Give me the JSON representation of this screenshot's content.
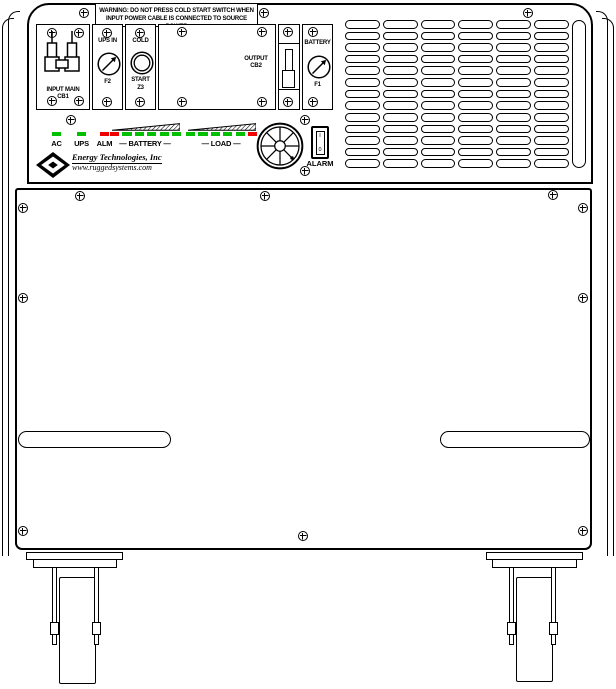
{
  "warning_label": {
    "line1": "WARNING: DO NOT PRESS COLD START SWITCH WHEN",
    "line2": "INPUT POWER CABLE IS CONNECTED TO SOURCE POWER"
  },
  "input_breaker": {
    "label_line1": "INPUT MAIN",
    "label_line2": "CB1"
  },
  "ups_input_fuse": {
    "top_label": "UPS IN",
    "bottom_label": "F2"
  },
  "cold_start": {
    "top_label": "COLD",
    "mid_label": "START",
    "bottom_label": "Z3"
  },
  "output_breaker": {
    "label_line1": "OUTPUT",
    "label_line2": "CB2"
  },
  "battery_fuse": {
    "top_label": "BATTERY",
    "bottom_label": "F1"
  },
  "alarm_switch": {
    "label": "ALARM",
    "on_mark": "I",
    "off_mark": "0"
  },
  "led_panel": {
    "singles": [
      {
        "label": "AC",
        "color": "green"
      },
      {
        "label": "UPS",
        "color": "green"
      },
      {
        "label": "ALM",
        "color": "red"
      }
    ],
    "battery_group": {
      "label": "— BATTERY —",
      "leds": [
        "red",
        "green",
        "green",
        "green",
        "green",
        "green"
      ]
    },
    "load_group": {
      "label": "— LOAD —",
      "leds": [
        "green",
        "green",
        "green",
        "green",
        "green",
        "red"
      ]
    }
  },
  "branding": {
    "company": "Energy Technologies, Inc",
    "website": "www.ruggedsystems.com"
  },
  "grille": {
    "columns": 6,
    "rows": 13
  },
  "colors": {
    "led_green": "#00C000",
    "led_red": "#EE0000",
    "line": "#000000",
    "background": "#FFFFFF"
  }
}
